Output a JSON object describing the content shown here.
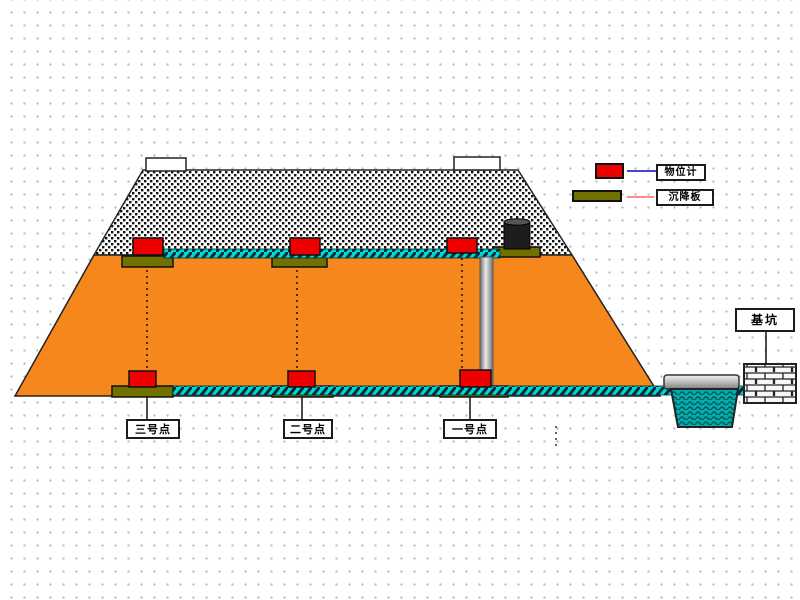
{
  "diagram": {
    "title_hint": "embankment settlement monitoring cross-section",
    "legend": {
      "items": [
        {
          "symbol": "level-gauge",
          "symbol_color": "#ee0000",
          "line_color": "#4444cc",
          "label": "物位计"
        },
        {
          "symbol": "settlement-plate",
          "symbol_color": "#717100",
          "line_color": "#ff8a8a",
          "label": "沉降板"
        }
      ]
    },
    "points": [
      {
        "label": "三号点"
      },
      {
        "label": "二号点"
      },
      {
        "label": "一号点"
      }
    ],
    "pit": {
      "label": "基坑"
    },
    "colors": {
      "embankment_fill": "#f6871d",
      "rockfill_pattern": "#111111",
      "rope": "#00d8d8",
      "pond": "#00acac",
      "gauge_red": "#ee0000",
      "plate_olive": "#717100",
      "outline": "#222222"
    }
  }
}
